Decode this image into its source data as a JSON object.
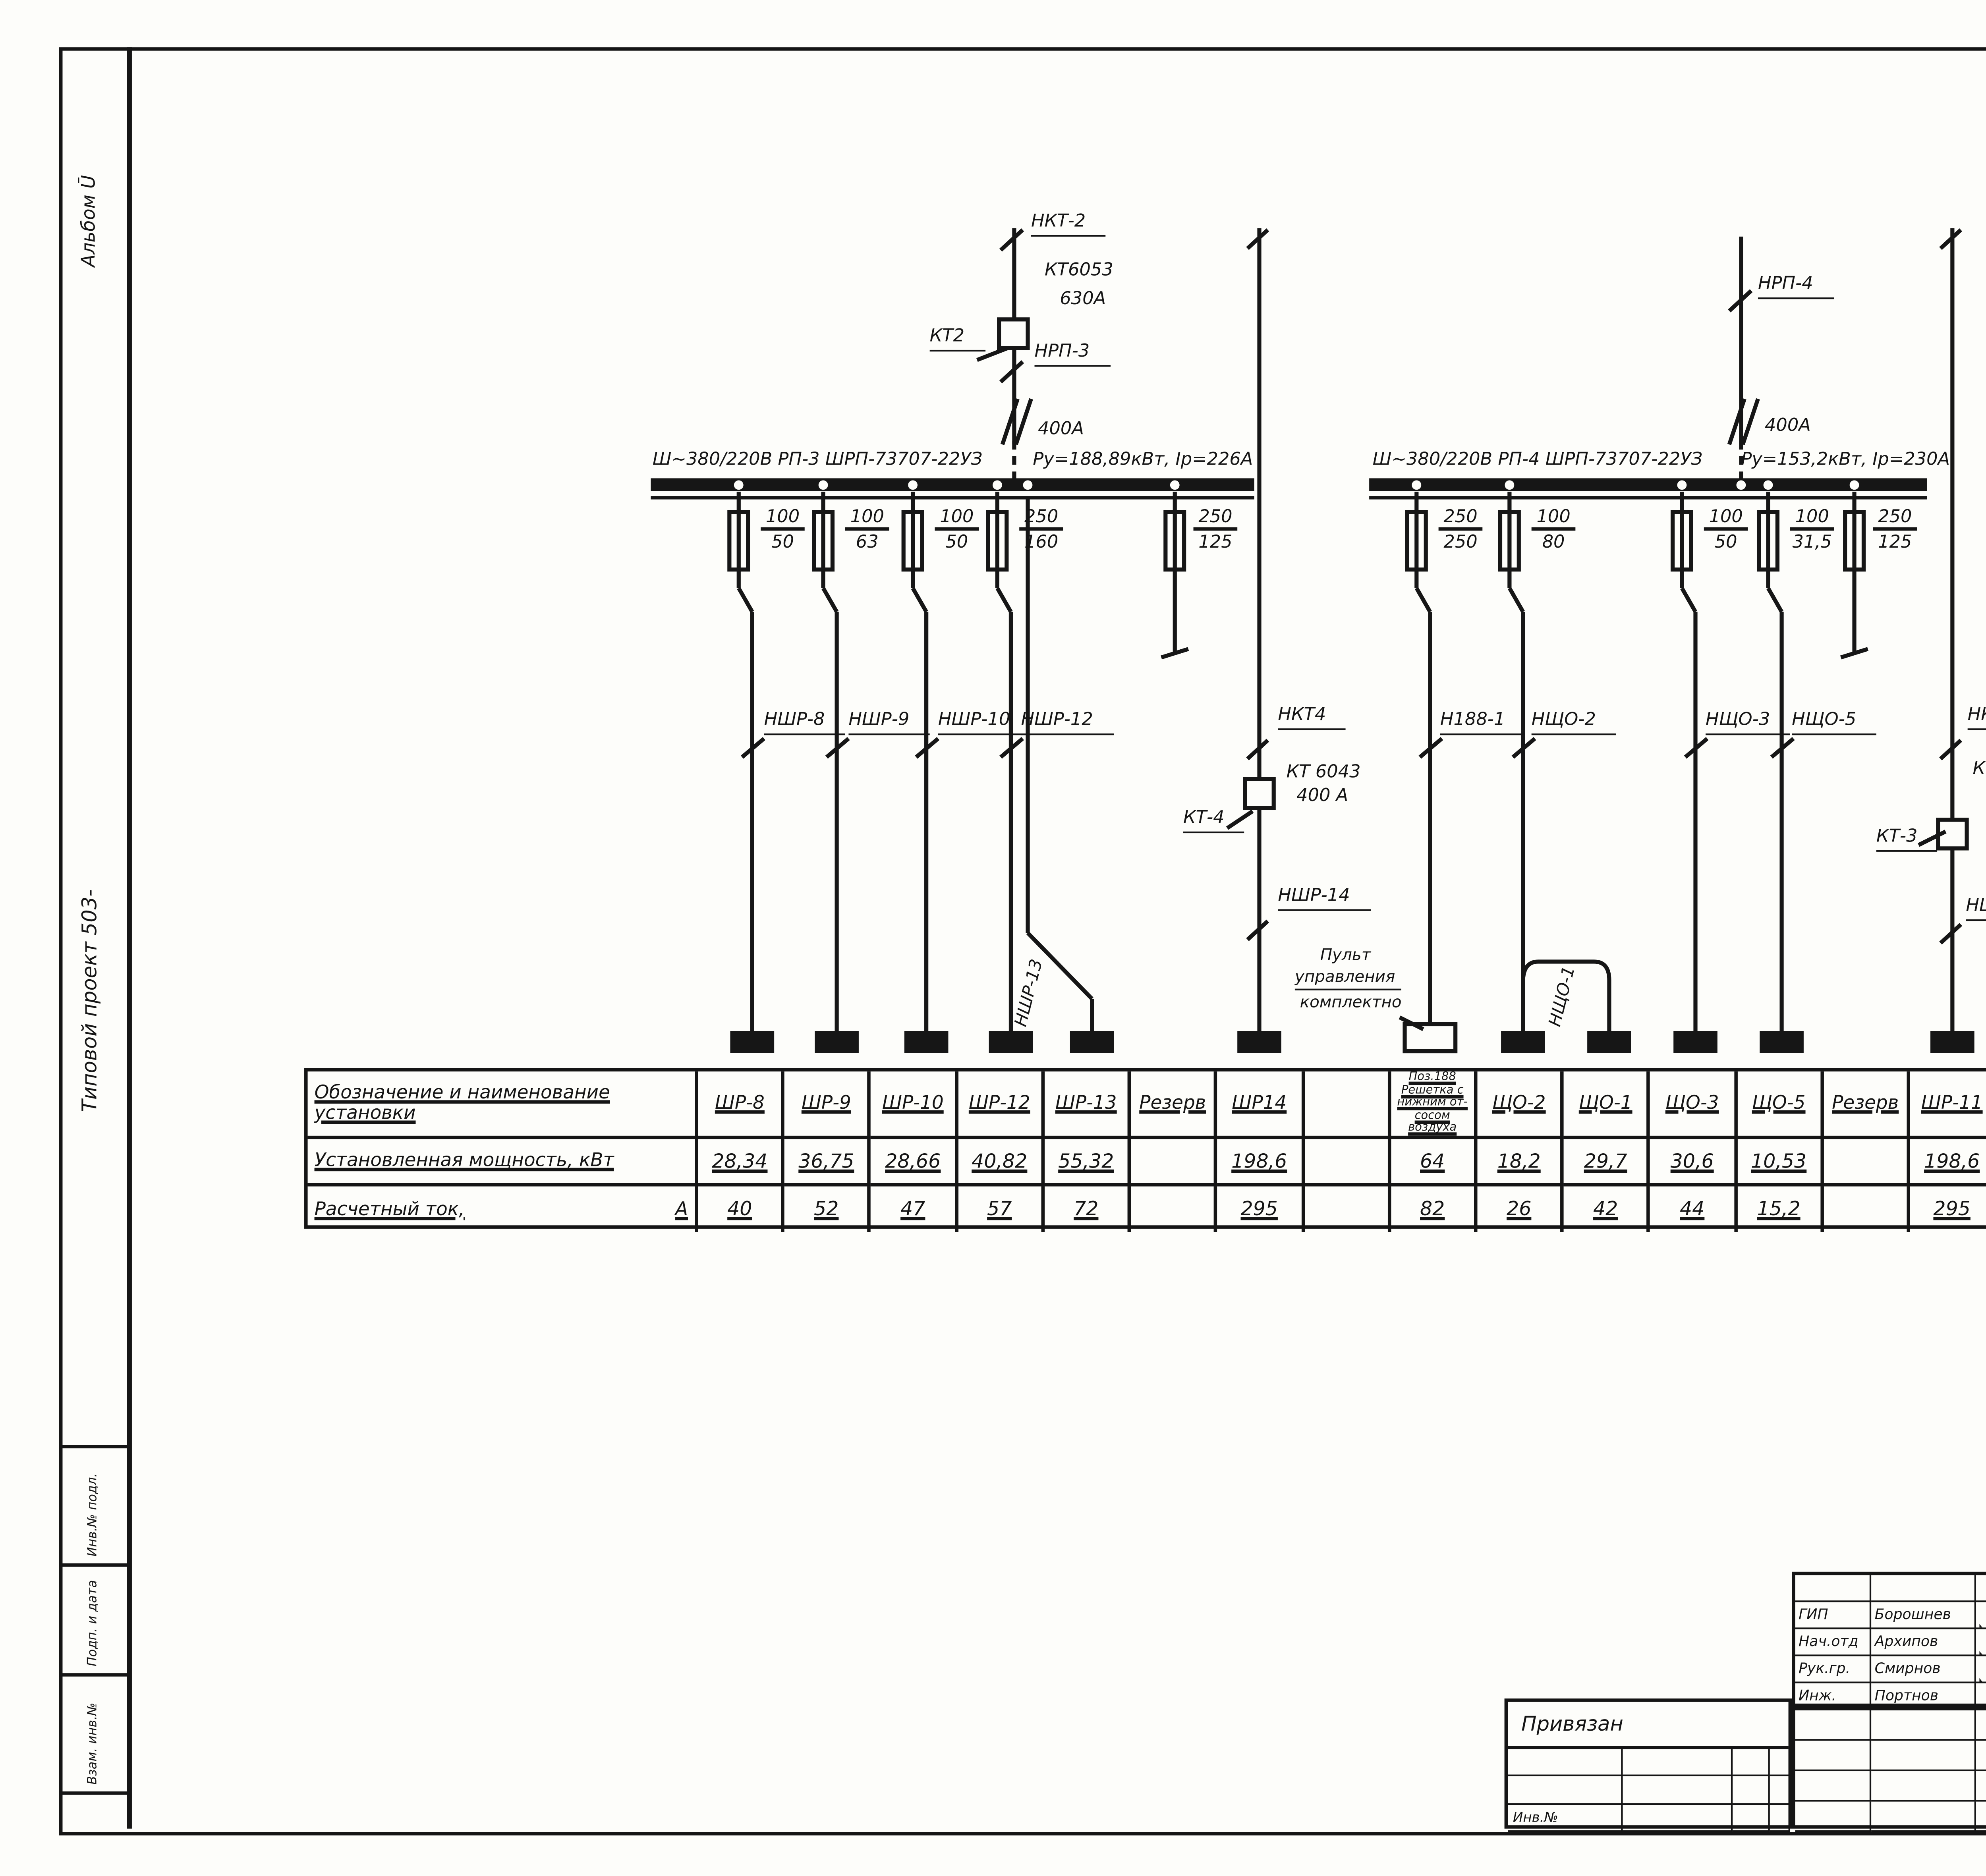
{
  "sheet": {
    "page_number": "8"
  },
  "margin": {
    "album": "Альбом Ū",
    "project": "Типовой проект 503-",
    "stamp1": "Инв.№ подл.",
    "stamp2": "Подп. и дата",
    "stamp3": "Взам. инв.№"
  },
  "rp3": {
    "incoming": {
      "cable": "НКТ-2",
      "kt_type": "КТ6053",
      "kt_amps": "630А",
      "kt_name": "КТ2",
      "outgoing": "НРП-3",
      "switch_amps": "400А"
    },
    "bus_title": "Ш~380/220В   РП-3   ШРП-73707-22УЗ",
    "bus_params": "Ру=188,89кВт, Iр=226А",
    "feeders": [
      {
        "num": "100",
        "den": "50",
        "cable": "НШР-8"
      },
      {
        "num": "100",
        "den": "63",
        "cable": "НШР-9"
      },
      {
        "num": "100",
        "den": "50",
        "cable": "НШР-10"
      },
      {
        "num": "250",
        "den": "160",
        "cable": "НШР-12"
      }
    ],
    "feeder13": {
      "cable": "НШР-13"
    },
    "reserve": {
      "num": "250",
      "den": "125"
    }
  },
  "shr14": {
    "top_cable": "НКТ4",
    "kt_type": "КТ 6043",
    "kt_amps": "400 А",
    "kt_name": "КТ-4",
    "bottom_cable": "НШР-14"
  },
  "pult": {
    "line1": "Пульт",
    "line2": "управления",
    "line3": "комплектно"
  },
  "rp4": {
    "incoming": {
      "cable": "НРП-4",
      "switch_amps": "400А"
    },
    "bus_title": "Ш~380/220В   РП-4   ШРП-73707-22УЗ",
    "bus_params": "Ру=153,2кВт, Iр=230А",
    "feeders": [
      {
        "num": "250",
        "den": "250",
        "cable": "Н188-1"
      },
      {
        "num": "100",
        "den": "80",
        "cable": "НЩО-2"
      },
      {
        "num": "100",
        "den": "50",
        "cable": "НЩО-3"
      },
      {
        "num": "100",
        "den": "31,5",
        "cable": "НЩО-5"
      }
    ],
    "jumper": {
      "cable": "НЩО-1"
    },
    "reserve": {
      "num": "250",
      "den": "125"
    }
  },
  "shr11": {
    "top_cable": "НКТ3",
    "kt_type": "КТ 6043",
    "kt_amps": "400А",
    "kt_name": "КТ-3",
    "bottom_cable": "НШР-11"
  },
  "table": {
    "r1": "Обозначение и наименование установки",
    "r2": "Установленная мощность, кВт",
    "r3": "Расчетный ток,",
    "r3_unit": "А",
    "columns": [
      {
        "h": "ШР-8",
        "p": "28,34",
        "c": "40"
      },
      {
        "h": "ШР-9",
        "p": "36,75",
        "c": "52"
      },
      {
        "h": "ШР-10",
        "p": "28,66",
        "c": "47"
      },
      {
        "h": "ШР-12",
        "p": "40,82",
        "c": "57"
      },
      {
        "h": "ШР-13",
        "p": "55,32",
        "c": "72"
      },
      {
        "h": "Резерв",
        "p": "",
        "c": ""
      },
      {
        "h": "ШР14",
        "p": "198,6",
        "c": "295"
      },
      {
        "h": "",
        "p": "",
        "c": ""
      },
      {
        "h": "Поз.188 Решетка с нижним от- сосом воздуха",
        "p": "64",
        "c": "82"
      },
      {
        "h": "ЩО-2",
        "p": "18,2",
        "c": "26"
      },
      {
        "h": "ЩО-1",
        "p": "29,7",
        "c": "42"
      },
      {
        "h": "ЩО-3",
        "p": "30,6",
        "c": "44"
      },
      {
        "h": "ЩО-5",
        "p": "10,53",
        "c": "15,2"
      },
      {
        "h": "Резерв",
        "p": "",
        "c": ""
      },
      {
        "h": "ШР-11",
        "p": "198,6",
        "c": "295"
      },
      {
        "h": "",
        "p": "",
        "c": ""
      },
      {
        "h": "",
        "p": "",
        "c": ""
      },
      {
        "h": "",
        "p": "",
        "c": ""
      }
    ]
  },
  "titleblock": {
    "signatures": [
      {
        "role": "ГИП",
        "name": "Борошнев"
      },
      {
        "role": "Нач.отд",
        "name": "Архипов"
      },
      {
        "role": "Рук.гр.",
        "name": "Смирнов"
      },
      {
        "role": "Инж.",
        "name": "Портнов"
      }
    ],
    "doc_number": "503-4-44м.87",
    "doc_mark": "ЭМ",
    "object_line1": "Автотранспортное предприятие на 150 грузовых",
    "object_line2": "автомобилей для северных районов",
    "building_line1": "Производственный корпус",
    "building_line2": "с закрытой стоянкой",
    "drawing_line1": "РП-3, РП-4. Схема электричес-",
    "drawing_line2": "кая принципиальная",
    "drawing_line3": "~380/220В",
    "stage_label": "Стадия",
    "sheet_label": "Лист",
    "sheets_label": "Листов",
    "stage": "РП",
    "sheet_no": "5",
    "sheets": "",
    "org": "ГИПРОАВТОТРАНС",
    "branch": "Новосибирский филиал",
    "attached": "Привязан",
    "inv": "Инв.№"
  }
}
